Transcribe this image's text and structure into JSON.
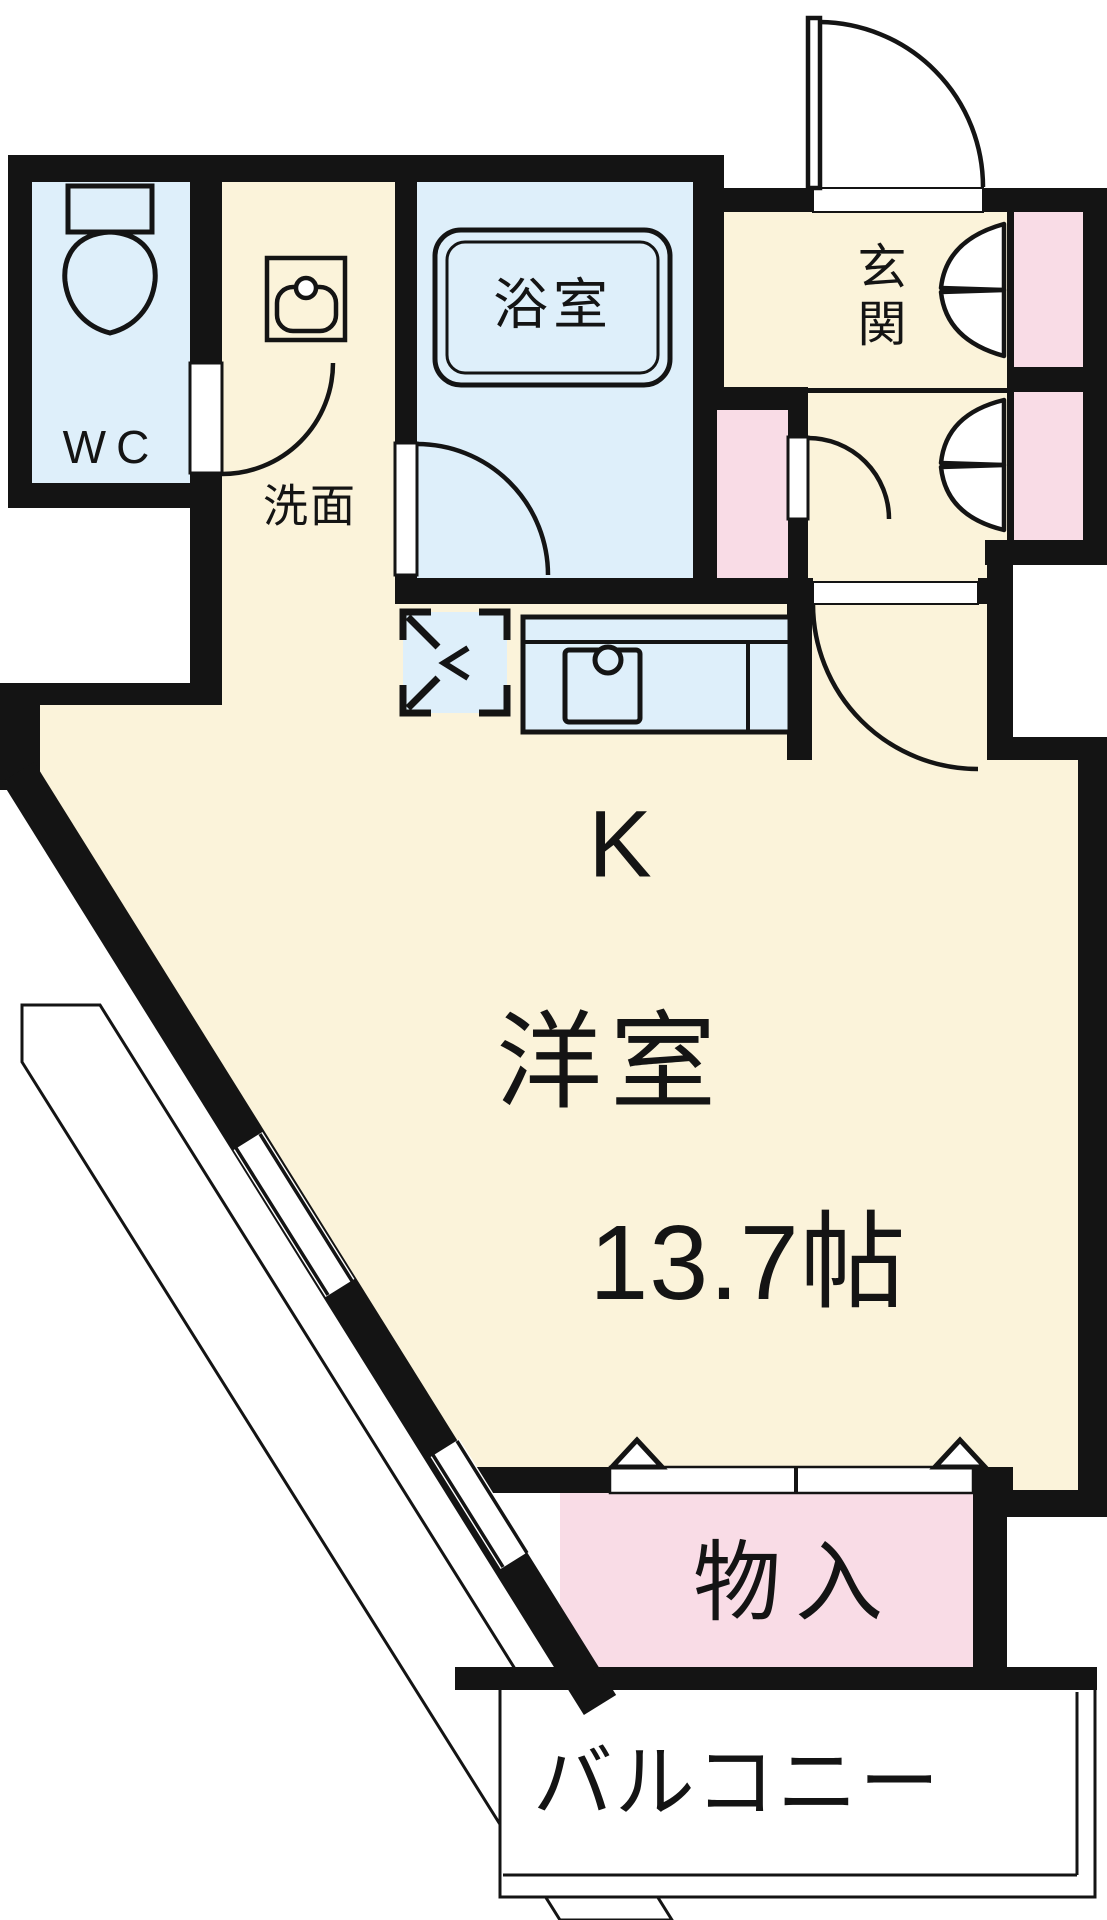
{
  "plan": {
    "rooms": {
      "wc": {
        "label": "WC"
      },
      "washroom": {
        "label": "洗面"
      },
      "bathroom": {
        "label": "浴室"
      },
      "entrance": {
        "label": "玄関"
      },
      "kitchen": {
        "label": "K"
      },
      "western_room": {
        "label": "洋室",
        "area_label": "13.7帖"
      },
      "storage": {
        "label": "物入"
      },
      "balcony": {
        "label": "バルコニー"
      }
    },
    "colors": {
      "room_floor": "#FBF3DA",
      "wet_area": "#DEEFFA",
      "closet": "#F9DCE6",
      "walls": "#141414",
      "background": "#FFFFFF"
    },
    "icons": [
      "toilet-icon",
      "washbasin-icon",
      "bathtub-icon",
      "kitchen-counter-icon",
      "kitchen-sink-icon",
      "refrigerator-space-icon",
      "door-swing-icon",
      "bifold-door-icon",
      "double-door-caret-icon",
      "window-icon",
      "balcony-outline"
    ]
  }
}
